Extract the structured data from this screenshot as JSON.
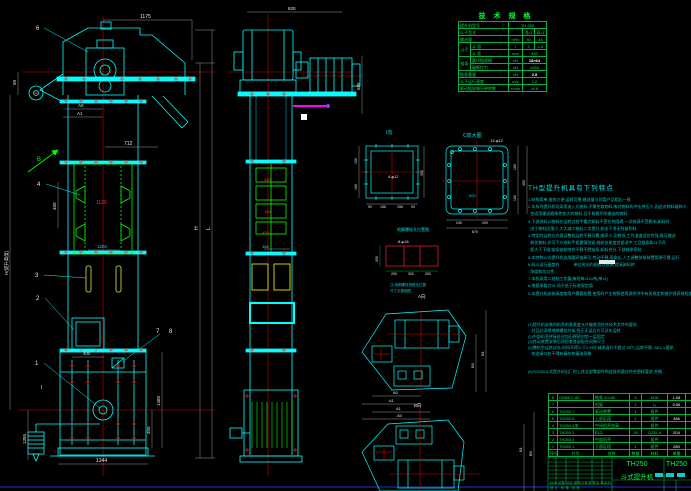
{
  "colors": {
    "background": "#000000",
    "line_cyan": "#00ffff",
    "line_green": "#00ff00",
    "centerline_red": "#d40000",
    "mark_red": "#ff2020",
    "dim_white": "#e6e6e6",
    "bucket_yellow": "#ffff00",
    "highlight_magenta": "#ff00ff",
    "table_green": "#00b44a",
    "notes_cyan": "#00c8c8",
    "frame_blue": "#2233cc"
  },
  "tech_table": {
    "title": "技 术 规 格",
    "model_label": "提升机型号",
    "model_value": "TH 250",
    "bucket_type_label": "斗子型式",
    "bucket_type_v1": "浅斗",
    "bucket_type_v2": "深斗",
    "capacity_label": "输送量",
    "capacity_unit": "m³/h",
    "capacity_v1": "30",
    "capacity_v2": "48",
    "bucket_group": "斗子",
    "bucket_vol_label": "斗 容",
    "bucket_vol_unit": "l",
    "bucket_vol_v1": "3",
    "bucket_vol_v2": "1.5",
    "bucket_pitch_label": "斗 距",
    "bucket_pitch_unit": "mm",
    "bucket_pitch_value": "480",
    "chain_group": "链条",
    "chain_spec_label": "圆环链规格",
    "chain_spec_unit": "kN",
    "chain_spec_value": "18×64",
    "chain_break_label": "破断拉力",
    "chain_break_unit": "kN",
    "chain_break_value": "≥350",
    "chain_weight_label": "链条重量",
    "chain_weight_unit": "kN",
    "chain_weight_value": "2.5",
    "speed_label": "斗子运行速度",
    "speed_unit": "m/s",
    "speed_value": "1.2",
    "rpm_label": "驱动链轮每分钟转数",
    "rpm_unit": "r/min",
    "rpm_value": "44.8"
  },
  "notes": {
    "title": "TH型提升机具有下列特点",
    "lines1": [
      "1.结构简单,维修方便,运转可靠,输送量与同类产品相比一致.",
      "2.本系列提升机均采用流入式装料,不需挖取物料,故对物料的冲击挤压小,因此对物料破碎少,",
      "  也适用输送磨琢性较大的物料,且不易损坏所输送的物料.",
      "3.下部进料斗物料在运转过程中重力卸料不受任何阻碍,一次装满不受影响,卸料时,",
      "  由于物料回落少,大大减少物料二次提升,卸出干净无残留积料.",
      "4.特定的运转方式保证整机运转平稳可靠,噪声小,功耗低,工作温度适应性强,既可输送",
      "  粉状物料,亦可下方给料手扳重锤张紧,链轮张紧度宜紧适中,工且链条和斗子间",
      "  距大于下限,链条链轮啮合平稳不脱链条,卸料充分,下部轴承密封.",
      "5.本特种斗式提升机选用圆环链牵引,传动平稳,寿命长,人工调整张紧装置简便可靠,运行",
      "6.料斗运行速度约            ,单位时间内卸料次数高,提高卸料的",
      "  净度和均匀性.",
      "7.本机采用二班制工作量(每班每斗31吨(单斗).",
      "8.地基承载力31 须不低于标准规定值.",
      "9.本提升机安装高度按用户需要配置,使用时户主按照使用说明书中有关规定和维护保养规程执行."
    ],
    "lines2": [
      "(1)提升机安装时机壳的垂直度允许偏差须符合技术文件的要求,",
      "   并且必须将地脚螺栓拧紧,找正无误后方可试车运转.",
      "(2)中部机壳拼接处应加石棉密封垫一层固定.",
      "(3)传动装置安装后须检查各部配合间隙尺寸.",
      "(4)整机空运转试车,时间不得少于2小时,轴承温升不超过 35℃,运转平稳, AEL.Y要求,",
      "   各连接口处不得有漏灰和漏油现象."
    ],
    "final_line": "(6)TH250斗式提升机出厂时上述全部零部件和连接质量应符合图样要求 合格."
  },
  "bom": {
    "headers": {
      "no": "序号",
      "code": "代号",
      "name": "名称",
      "qty": "数量",
      "mat": "材料",
      "wt": "单重",
      "rem": "备注"
    },
    "rows": [
      {
        "no": "8",
        "code": "GB5927-86",
        "name": "链条 20×80",
        "qty": "4",
        "mat": "M16",
        "wt": "1.08"
      },
      {
        "no": "7",
        "code": "",
        "name": "机架",
        "qty": "1",
        "mat": "L₅",
        "wt": "0.06"
      },
      {
        "no": "6",
        "code": "TH250.7",
        "name": "驱动装置",
        "qty": "1",
        "mat": "组件",
        "wt": ""
      },
      {
        "no": "5",
        "code": "TH250.6",
        "name": "上部区段",
        "qty": "1",
        "mat": "组件",
        "wt": "386"
      },
      {
        "no": "4",
        "code": "TH250.4加",
        "name": "中间机壳加高",
        "qty": "",
        "mat": "组件",
        "wt": ""
      },
      {
        "no": "3",
        "code": "TH250.3",
        "name": "料斗",
        "qty": "28",
        "mat": "Q235-A",
        "wt": "204"
      },
      {
        "no": "2",
        "code": "TH250.2",
        "name": "中部机壳",
        "qty": "",
        "mat": "组件",
        "wt": ""
      },
      {
        "no": "1",
        "code": "TH250.1",
        "name": "下部区段",
        "qty": "1",
        "mat": "组件",
        "wt": "280"
      }
    ]
  },
  "title_block": {
    "product_model": "TH250",
    "product_name": "斗式提升机",
    "drawing_no": "TH250",
    "rev_row": "标记 处数 分区 更改文件号 签名 年月日",
    "sign_row": "设 计   校 核   批 准"
  },
  "front": {
    "dim_top": "1175",
    "dim_chute": "712",
    "dim_a0": "A0",
    "dim_a1": "A1",
    "dim_left_small": "50",
    "dim_pitch": "450",
    "dim_mid_red": "1130",
    "dim_mid2": "1202",
    "dim_door": "400",
    "dim_base": "1344",
    "dim_boot1": "350",
    "dim_boot2": "1460",
    "dim_takeup": "1355",
    "dim_h_right": "H",
    "dim_l_right": "L",
    "dim_h_left": "H(提升高度)",
    "section_mark": "I",
    "view_arrow": "B"
  },
  "side": {
    "dim_top": "820",
    "dim_right": "585",
    "d1": "250",
    "d2": "180",
    "d3": "435",
    "d4": "388"
  },
  "detail_i": {
    "label": "I向",
    "holes": "4-φ12",
    "left1": "160",
    "left2": "160",
    "right": "300",
    "b1": "90",
    "b2": "156",
    "b3": "156",
    "b4": "90"
  },
  "detail_c": {
    "label": "C放大图",
    "holes": "13-φ12",
    "inner": "600",
    "r1": "160",
    "r2": "160",
    "r_total": "450",
    "b1": "240",
    "b2": "200",
    "b_total": "670"
  },
  "anchor": {
    "title": "地脚螺栓孔位置图",
    "holes": "8-φ18",
    "left": "450",
    "b1": "200",
    "b2": "300",
    "b3": "200",
    "note1": "注:地脚螺栓规格及位置",
    "note2": "尺寸见基础图"
  },
  "view_a": {
    "label": "A向",
    "a0": "A0",
    "a1": "A1",
    "b0": "B0",
    "b1": "B1"
  },
  "view_b": {
    "label": "B向",
    "a0": "A0",
    "a1": "A1",
    "b0": "B0",
    "b1": "B1"
  },
  "balloons": {
    "n1": "1",
    "n2": "2",
    "n3": "3",
    "n4": "4",
    "n6": "6",
    "n7": "7",
    "n8": "8"
  }
}
